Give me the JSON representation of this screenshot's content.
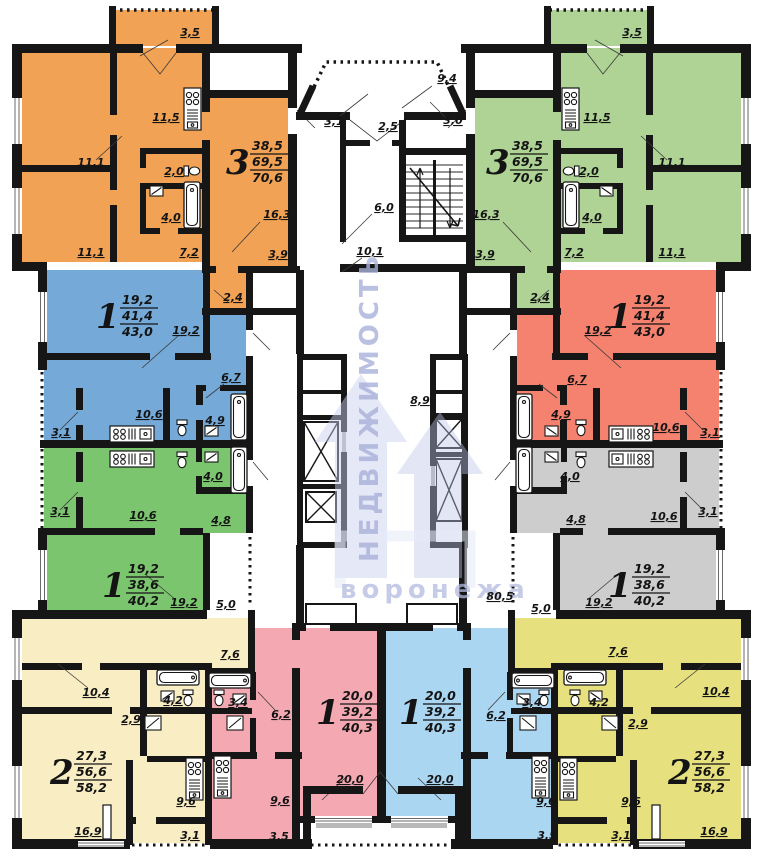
{
  "watermark": {
    "vertical": "НЕДВИЖИМОСТЬ",
    "horizontal": "воронежа",
    "color": "#a8b1da"
  },
  "fixtures": [
    "stove-icon",
    "sink-icon",
    "bathtub-icon",
    "toilet-icon",
    "washbasin-icon",
    "elevator-shaft",
    "staircase"
  ],
  "apartments": [
    {
      "name": "apt-3room-top-left",
      "rooms": "3",
      "living_area": "38,5",
      "total_area": "69,5",
      "total_with_loggia": "70,6",
      "color": "#f1a254",
      "pos": {
        "x": 226,
        "y": 158
      }
    },
    {
      "name": "apt-3room-top-right",
      "rooms": "3",
      "living_area": "38,5",
      "total_area": "69,5",
      "total_with_loggia": "70,6",
      "color": "#aed394",
      "pos": {
        "x": 486,
        "y": 158
      }
    },
    {
      "name": "apt-1room-left",
      "rooms": "1",
      "living_area": "19,2",
      "total_area": "41,4",
      "total_with_loggia": "43,0",
      "color": "#74a9d8",
      "pos": {
        "x": 96,
        "y": 312
      }
    },
    {
      "name": "apt-1room-right",
      "rooms": "1",
      "living_area": "19,2",
      "total_area": "41,4",
      "total_with_loggia": "43,0",
      "color": "#f5816f",
      "pos": {
        "x": 608,
        "y": 312
      }
    },
    {
      "name": "apt-1room-mid-left",
      "rooms": "1",
      "living_area": "19,2",
      "total_area": "38,6",
      "total_with_loggia": "40,2",
      "color": "#7cc56f",
      "pos": {
        "x": 102,
        "y": 581
      }
    },
    {
      "name": "apt-1room-mid-right",
      "rooms": "1",
      "living_area": "19,2",
      "total_area": "38,6",
      "total_with_loggia": "40,2",
      "color": "#cdcdcd",
      "pos": {
        "x": 608,
        "y": 581
      }
    },
    {
      "name": "apt-2room-bottom-left",
      "rooms": "2",
      "living_area": "27,3",
      "total_area": "56,6",
      "total_with_loggia": "58,2",
      "color": "#f9edc4",
      "pos": {
        "x": 50,
        "y": 768
      }
    },
    {
      "name": "apt-2room-bottom-right",
      "rooms": "2",
      "living_area": "27,3",
      "total_area": "56,6",
      "total_with_loggia": "58,2",
      "color": "#e6e07f",
      "pos": {
        "x": 668,
        "y": 768
      }
    },
    {
      "name": "apt-1room-bottom-center-left",
      "rooms": "1",
      "living_area": "20,0",
      "total_area": "39,2",
      "total_with_loggia": "40,3",
      "color": "#f4a9b2",
      "pos": {
        "x": 316,
        "y": 708
      }
    },
    {
      "name": "apt-1room-bottom-center-right",
      "rooms": "1",
      "living_area": "20,0",
      "total_area": "39,2",
      "total_with_loggia": "40,3",
      "color": "#abd6f2",
      "pos": {
        "x": 399,
        "y": 708
      }
    }
  ],
  "dim_labels": [
    {
      "t": "3,5",
      "x": 190,
      "y": 36
    },
    {
      "t": "9,4",
      "x": 447,
      "y": 82
    },
    {
      "t": "3,5",
      "x": 632,
      "y": 36
    },
    {
      "t": "3,1",
      "x": 334,
      "y": 125
    },
    {
      "t": "2,5",
      "x": 388,
      "y": 130
    },
    {
      "t": "3,0",
      "x": 453,
      "y": 124
    },
    {
      "t": "6,0",
      "x": 384,
      "y": 211
    },
    {
      "t": "10,1",
      "x": 370,
      "y": 255
    },
    {
      "t": "8,9",
      "x": 420,
      "y": 404
    },
    {
      "t": "80,5",
      "x": 500,
      "y": 600
    },
    {
      "t": "11,5",
      "x": 166,
      "y": 121
    },
    {
      "t": "11,1",
      "x": 91,
      "y": 166
    },
    {
      "t": "2,0",
      "x": 174,
      "y": 175
    },
    {
      "t": "4,0",
      "x": 171,
      "y": 221
    },
    {
      "t": "11,1",
      "x": 91,
      "y": 256
    },
    {
      "t": "7,2",
      "x": 189,
      "y": 256
    },
    {
      "t": "16,3",
      "x": 277,
      "y": 218
    },
    {
      "t": "3,9",
      "x": 278,
      "y": 258
    },
    {
      "t": "2,4",
      "x": 233,
      "y": 301
    },
    {
      "t": "11,5",
      "x": 597,
      "y": 121
    },
    {
      "t": "11,1",
      "x": 672,
      "y": 166
    },
    {
      "t": "2,0",
      "x": 589,
      "y": 175
    },
    {
      "t": "4,0",
      "x": 592,
      "y": 221
    },
    {
      "t": "11,1",
      "x": 672,
      "y": 256
    },
    {
      "t": "7,2",
      "x": 574,
      "y": 256
    },
    {
      "t": "16,3",
      "x": 486,
      "y": 218
    },
    {
      "t": "3,9",
      "x": 485,
      "y": 258
    },
    {
      "t": "2,4",
      "x": 540,
      "y": 301
    },
    {
      "t": "19,2",
      "x": 186,
      "y": 334
    },
    {
      "t": "6,7",
      "x": 231,
      "y": 381
    },
    {
      "t": "10,6",
      "x": 149,
      "y": 418
    },
    {
      "t": "4,9",
      "x": 215,
      "y": 424
    },
    {
      "t": "3,1",
      "x": 61,
      "y": 436
    },
    {
      "t": "19,2",
      "x": 598,
      "y": 334
    },
    {
      "t": "6,7",
      "x": 577,
      "y": 383
    },
    {
      "t": "4,9",
      "x": 561,
      "y": 418
    },
    {
      "t": "10,6",
      "x": 666,
      "y": 431
    },
    {
      "t": "3,1",
      "x": 710,
      "y": 436
    },
    {
      "t": "4,0",
      "x": 213,
      "y": 480
    },
    {
      "t": "10,6",
      "x": 143,
      "y": 519
    },
    {
      "t": "4,8",
      "x": 221,
      "y": 524
    },
    {
      "t": "3,1",
      "x": 60,
      "y": 515
    },
    {
      "t": "19,2",
      "x": 184,
      "y": 606
    },
    {
      "t": "5,0",
      "x": 226,
      "y": 608
    },
    {
      "t": "4,0",
      "x": 570,
      "y": 480
    },
    {
      "t": "4,8",
      "x": 576,
      "y": 523
    },
    {
      "t": "10,6",
      "x": 664,
      "y": 520
    },
    {
      "t": "3,1",
      "x": 708,
      "y": 515
    },
    {
      "t": "19,2",
      "x": 599,
      "y": 606
    },
    {
      "t": "5,0",
      "x": 541,
      "y": 612
    },
    {
      "t": "7,6",
      "x": 230,
      "y": 658
    },
    {
      "t": "10,4",
      "x": 96,
      "y": 696
    },
    {
      "t": "4,2",
      "x": 173,
      "y": 704
    },
    {
      "t": "2,9",
      "x": 131,
      "y": 723
    },
    {
      "t": "9,6",
      "x": 186,
      "y": 805
    },
    {
      "t": "16,9",
      "x": 88,
      "y": 835
    },
    {
      "t": "3,1",
      "x": 190,
      "y": 839
    },
    {
      "t": "7,6",
      "x": 618,
      "y": 655
    },
    {
      "t": "10,4",
      "x": 716,
      "y": 695
    },
    {
      "t": "4,2",
      "x": 599,
      "y": 706
    },
    {
      "t": "2,9",
      "x": 638,
      "y": 727
    },
    {
      "t": "9,6",
      "x": 631,
      "y": 805
    },
    {
      "t": "16,9",
      "x": 714,
      "y": 835
    },
    {
      "t": "3,1",
      "x": 621,
      "y": 839
    },
    {
      "t": "6,2",
      "x": 281,
      "y": 718
    },
    {
      "t": "3,4",
      "x": 238,
      "y": 706
    },
    {
      "t": "20,0",
      "x": 350,
      "y": 783
    },
    {
      "t": "9,6",
      "x": 280,
      "y": 804
    },
    {
      "t": "3,5",
      "x": 279,
      "y": 840
    },
    {
      "t": "6,2",
      "x": 496,
      "y": 719
    },
    {
      "t": "3,4",
      "x": 532,
      "y": 706
    },
    {
      "t": "20,0",
      "x": 440,
      "y": 783
    },
    {
      "t": "9,6",
      "x": 546,
      "y": 805
    },
    {
      "t": "3,5",
      "x": 547,
      "y": 839
    }
  ]
}
